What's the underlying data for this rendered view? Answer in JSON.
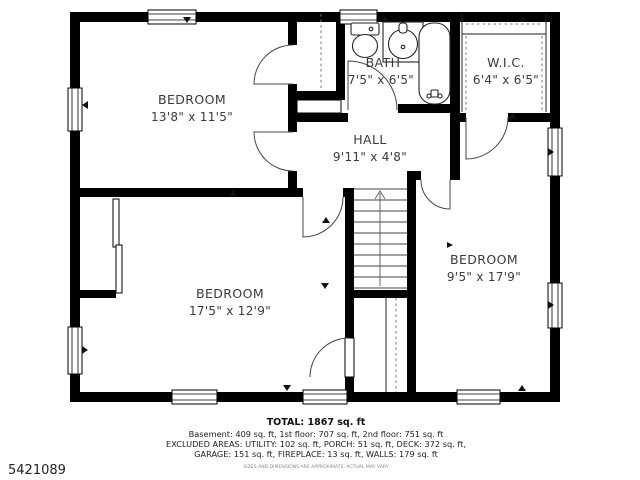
{
  "plan_id": "5421089",
  "rooms": [
    {
      "name": "BEDROOM",
      "dims": "13'8\" x 11'5\""
    },
    {
      "name": "BATH",
      "dims": "7'5\" x 6'5\""
    },
    {
      "name": "W.I.C.",
      "dims": "6'4\" x 6'5\""
    },
    {
      "name": "HALL",
      "dims": "9'11\" x 4'8\""
    },
    {
      "name": "BEDROOM",
      "dims": "17'5\" x 12'9\""
    },
    {
      "name": "BEDROOM",
      "dims": "9'5\" x 17'9\""
    }
  ],
  "summary": {
    "total": "TOTAL: 1867 sq. ft",
    "floors": "Basement: 409 sq. ft, 1st floor: 707 sq. ft, 2nd floor: 751 sq. ft",
    "excluded1": "EXCLUDED AREAS: UTILITY: 102 sq. ft, PORCH: 51 sq. ft, DECK: 372 sq. ft,",
    "excluded2": "GARAGE: 151 sq. ft, FIREPLACE: 13 sq. ft, WALLS: 179 sq. ft",
    "disclaimer": "SIZES AND DIMENSIONS ARE APPROXIMATE, ACTUAL MAY VARY"
  },
  "colors": {
    "wall": "#000000",
    "background": "#ffffff",
    "label": "#3a3a3a"
  }
}
